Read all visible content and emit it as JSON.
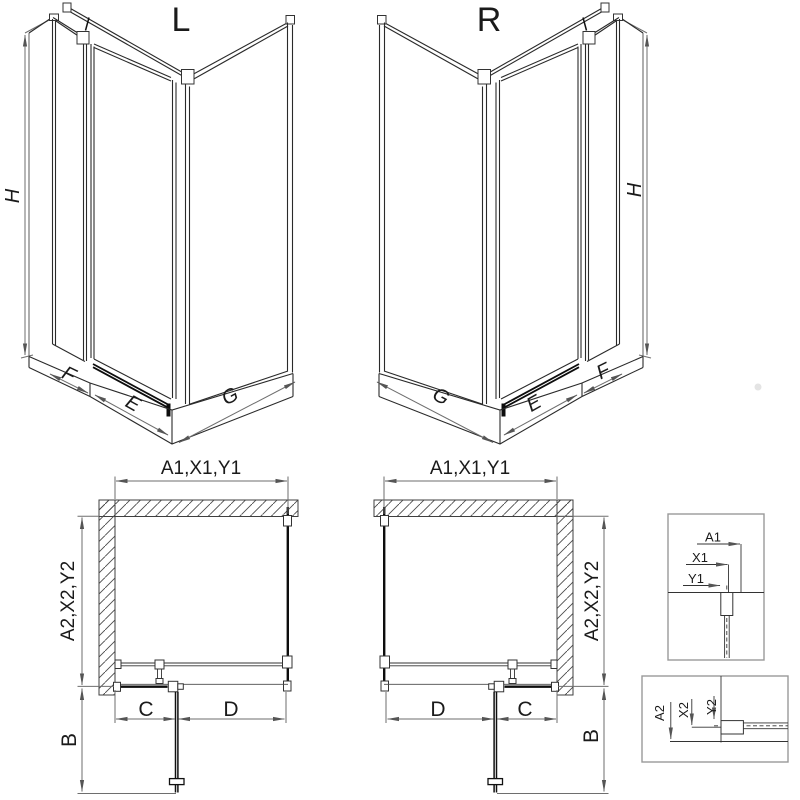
{
  "drawing": {
    "iso_left": {
      "label": "L",
      "dim_height": "H",
      "dim_side": "F",
      "dim_door": "E",
      "dim_base": "G"
    },
    "iso_right": {
      "label": "R",
      "dim_height": "H",
      "dim_side": "F",
      "dim_door": "E",
      "dim_base": "G"
    },
    "plan_left": {
      "dim_width": "A1,X1,Y1",
      "dim_depth": "A2,X2,Y2",
      "dim_door_open": "B",
      "dim_fixed": "C",
      "dim_door": "D"
    },
    "plan_right": {
      "dim_width": "A1,X1,Y1",
      "dim_depth": "A2,X2,Y2",
      "dim_door_open": "B",
      "dim_fixed": "C",
      "dim_door": "D"
    },
    "detail_width": {
      "dim_total": "A1",
      "dim_profile": "X1",
      "dim_glass": "Y1"
    },
    "detail_depth": {
      "dim_total": "A2",
      "dim_profile": "X2",
      "dim_glass": "Y2"
    }
  },
  "colors": {
    "line": "#2a2a2a",
    "glass_line": "#0d0d0d",
    "dimension_line": "#6e6e6e",
    "text": "#1a1a1a",
    "hatch": "#4a4a4a",
    "detail_frame": "#999999",
    "background": "#ffffff"
  }
}
